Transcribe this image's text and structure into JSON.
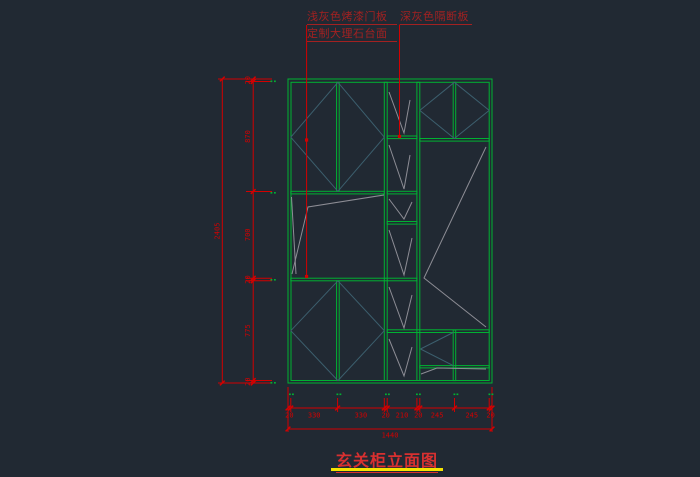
{
  "title": {
    "text": "玄关柜立面图"
  },
  "annotations": {
    "label_door": "浅灰色烤漆门板",
    "label_marble": "定制大理石台面",
    "label_partition": "深灰色隔断板"
  },
  "dimensions": {
    "bottom_segments": [
      "20",
      "330",
      "330",
      "20",
      "210",
      "20",
      "245",
      "245",
      "20"
    ],
    "bottom_total": "1440",
    "left_segments": [
      "20",
      "870",
      "700",
      "20",
      "775",
      "20"
    ],
    "left_total": "2405"
  },
  "colors": {
    "background": "#212933",
    "line_green": "#00b232",
    "swing_teal": "#3c5f6e",
    "depth_gray": "#8d8d95",
    "dimension_red": "#d40000",
    "label_red": "#a32121",
    "title_red": "#d83030",
    "underline_yellow": "#f5e400"
  }
}
